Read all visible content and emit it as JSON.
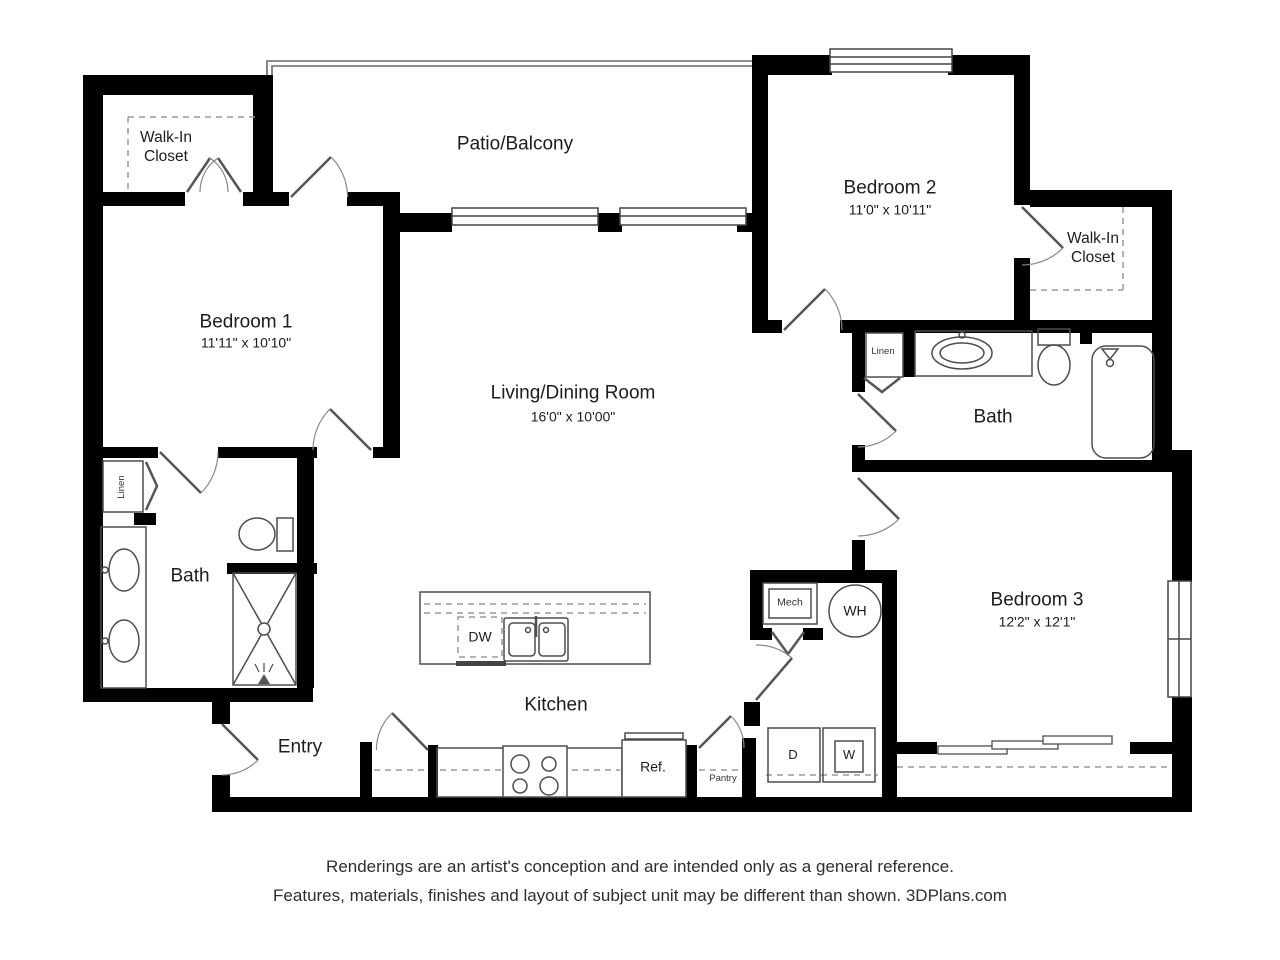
{
  "plan": {
    "rooms": {
      "walk_in_closet_1": {
        "name": "Walk-In\nCloset"
      },
      "patio": {
        "name": "Patio/Balcony"
      },
      "bedroom1": {
        "name": "Bedroom 1",
        "dims": "11'11\" x 10'10\""
      },
      "bedroom2": {
        "name": "Bedroom 2",
        "dims": "11'0\" x 10'11\""
      },
      "walk_in_closet_2": {
        "name": "Walk-In\nCloset"
      },
      "living": {
        "name": "Living/Dining Room",
        "dims": "16'0\" x 10'00\""
      },
      "bath_left": {
        "name": "Bath"
      },
      "bath_right": {
        "name": "Bath"
      },
      "bedroom3": {
        "name": "Bedroom 3",
        "dims": "12'2\" x 12'1\""
      },
      "kitchen": {
        "name": "Kitchen"
      },
      "entry": {
        "name": "Entry"
      }
    },
    "labels": {
      "linen_left": "Linen",
      "linen_right": "Linen",
      "dishwasher": "DW",
      "mechanical": "Mech",
      "water_heater": "WH",
      "refrigerator": "Ref.",
      "pantry": "Pantry",
      "dryer": "D",
      "washer": "W"
    }
  },
  "footer": {
    "line1": "Renderings are an artist's conception and are intended only as a general reference.",
    "line2": "Features, materials, finishes and layout of subject unit may be different than shown. 3DPlans.com"
  },
  "colors": {
    "wall": "#000000",
    "line": "#4d4d4d",
    "dash": "#9a9a9a",
    "text": "#1c1c1c"
  }
}
